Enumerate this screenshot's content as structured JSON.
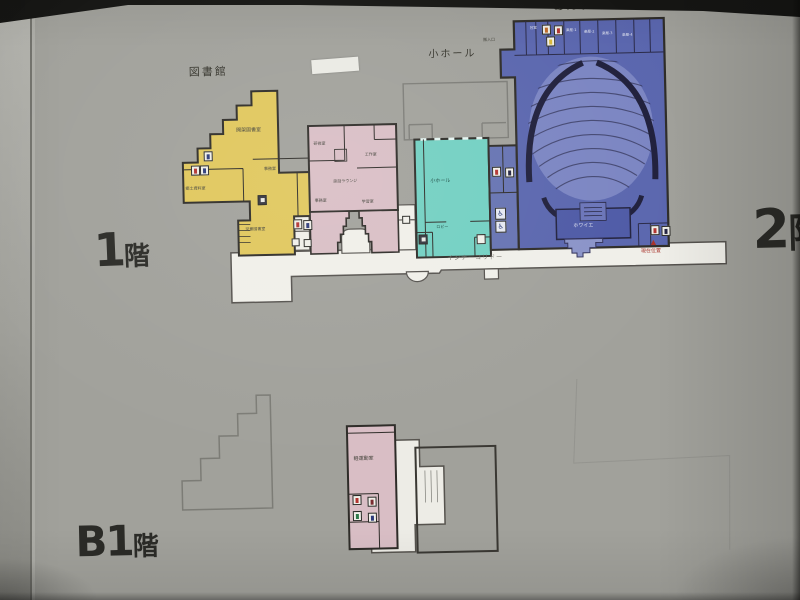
{
  "floors": {
    "f1": {
      "number": "1",
      "suffix": "階"
    },
    "b1": {
      "number": "B1",
      "suffix": "階"
    },
    "f2": {
      "number": "2",
      "suffix": "階"
    }
  },
  "library": {
    "title": "図書館",
    "rooms": {
      "open_stack": "開架図書室",
      "office": "事務室",
      "local_history": "郷土資料室",
      "children": "児童図書室"
    }
  },
  "community": {
    "rooms": {
      "training": "研修室",
      "craft": "工作室",
      "lounge": "談話ラウンジ",
      "office": "事務室",
      "study": "学習室"
    }
  },
  "small_hall": {
    "title": "小ホール",
    "rooms": {
      "hall": "小ホール",
      "lobby": "ロビー"
    }
  },
  "anzu_hall": {
    "title": "あんずホール",
    "rooms": {
      "green_room": "控室",
      "dressing": [
        "楽屋-1",
        "楽屋-2",
        "楽屋-3",
        "楽屋-4"
      ],
      "foyer": "ホワイエ",
      "load_in": "搬入口"
    }
  },
  "basement": {
    "rooms": {
      "exercise": "軽運動室"
    }
  },
  "corridor": {
    "label": "インナーコリドー"
  },
  "location_marker": {
    "symbol": "▲",
    "label": "現在位置"
  },
  "icons": [
    "womens-toilet",
    "mens-toilet",
    "accessible-toilet",
    "elevator",
    "stairs"
  ],
  "colors": {
    "sign_bg": "#a1a19b",
    "library_fill": "#e0c75c",
    "community_fill": "#d9bec5",
    "small_hall_fill": "#72d0c2",
    "anzu_fill": "#5a66ae",
    "anzu_rooms_fill": "#6673b2",
    "corridor_fill": "#f0efe9",
    "outline": "#2e2c28",
    "ghost_outline": "#7d7d78",
    "marker_red": "#a8322a"
  }
}
